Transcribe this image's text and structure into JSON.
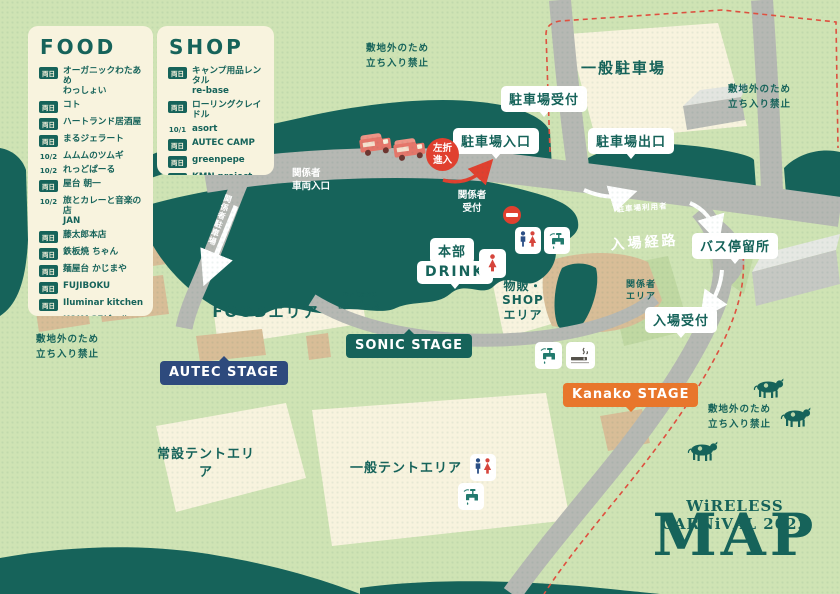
{
  "event": {
    "name_line": "WiRELESS CARNiVAL 2022",
    "map_word": "MAP"
  },
  "legend": {
    "food": {
      "heading": "FOOD",
      "items": [
        {
          "day": "両日",
          "name": "オーガニックわたあめ\nわっしょい"
        },
        {
          "day": "両日",
          "name": "コト"
        },
        {
          "day": "両日",
          "name": "ハートランド居酒屋"
        },
        {
          "day": "両日",
          "name": "まるジェラート"
        },
        {
          "day": "10/2",
          "name": "ムムムのツムギ"
        },
        {
          "day": "10/2",
          "name": "れっどぱーる"
        },
        {
          "day": "両日",
          "name": "屋台 朝一"
        },
        {
          "day": "10/2",
          "name": "旅とカレーと音楽の店\nJAN"
        },
        {
          "day": "両日",
          "name": "藤太郎本店"
        },
        {
          "day": "両日",
          "name": "鉄板焼 ちゃん"
        },
        {
          "day": "両日",
          "name": "麺屋台 かじまや"
        },
        {
          "day": "両日",
          "name": "FUJIBOKU"
        },
        {
          "day": "両日",
          "name": "Iluminar kitchen"
        },
        {
          "day": "両日",
          "name": "KOKAGEビール"
        },
        {
          "day": "10/1",
          "name": "SUN CAFE"
        },
        {
          "day": "両日",
          "name": "SURPRICE NIPPON"
        },
        {
          "day": "10/1",
          "name": "TOYBOX"
        }
      ]
    },
    "shop": {
      "heading": "SHOP",
      "items": [
        {
          "day": "両日",
          "name": "キャンプ用品レンタル\nre-base"
        },
        {
          "day": "両日",
          "name": "ローリングクレイドル"
        },
        {
          "day": "10/1",
          "name": "asort"
        },
        {
          "day": "両日",
          "name": "AUTEC CAMP"
        },
        {
          "day": "両日",
          "name": "greenpepe"
        },
        {
          "day": "両日",
          "name": "KMN project",
          "sub": "(キモノプロジェクト)"
        },
        {
          "day": "両日",
          "name": "MELTTOWN"
        }
      ]
    }
  },
  "map": {
    "off_limits": "敷地外のため\n立ち入り禁止",
    "general_parking": "一般駐車場",
    "parking_reception": "駐車場受付",
    "parking_entrance": "駐車場入口",
    "parking_exit": "駐車場出口",
    "left_turn": "左折\n進入",
    "staff_vehicle_gate": "関係者\n車両入口",
    "staff_parking_road": "関係者駐車場",
    "staff_reception": "関係者\n受付",
    "entry_route_note": "駐車場利用者",
    "entry_route": "入場経路",
    "bus_stop": "バス停留所",
    "hq": "本部",
    "drink": "DRINK",
    "goods_shop_area": "物販・\nSHOP\nエリア",
    "staff_area": "関係者\nエリア",
    "entry_reception": "入場受付",
    "rebase_booth": "re-base\n出店ブース",
    "food_area": "FOODエリア",
    "sonic_stage": "SONIC STAGE",
    "autec_stage": "AUTEC STAGE",
    "kanako_stage": "Kanako STAGE",
    "permanent_tent_area": "常設テントエリア",
    "general_tent_area": "一般テントエリア"
  },
  "icons": {
    "restroom": "restroom-icon",
    "restroom_women": "women-restroom-icon",
    "water_tap": "water-tap-icon",
    "smoking_area": "smoking-area-icon",
    "no_entry": "no-entry-icon",
    "left_turn_badge": "left-turn-badge",
    "food_truck": "food-truck-icon",
    "cow": "cow-icon"
  },
  "colors": {
    "background": "#cfe3b4",
    "forest": "#16635a",
    "road": "#b6b8b3",
    "cream": "#f8f3de",
    "tan": "#d8bd97",
    "red": "#e0402f",
    "navy": "#2e4a7d",
    "orange": "#e8762c",
    "teal_text": "#16635a"
  }
}
